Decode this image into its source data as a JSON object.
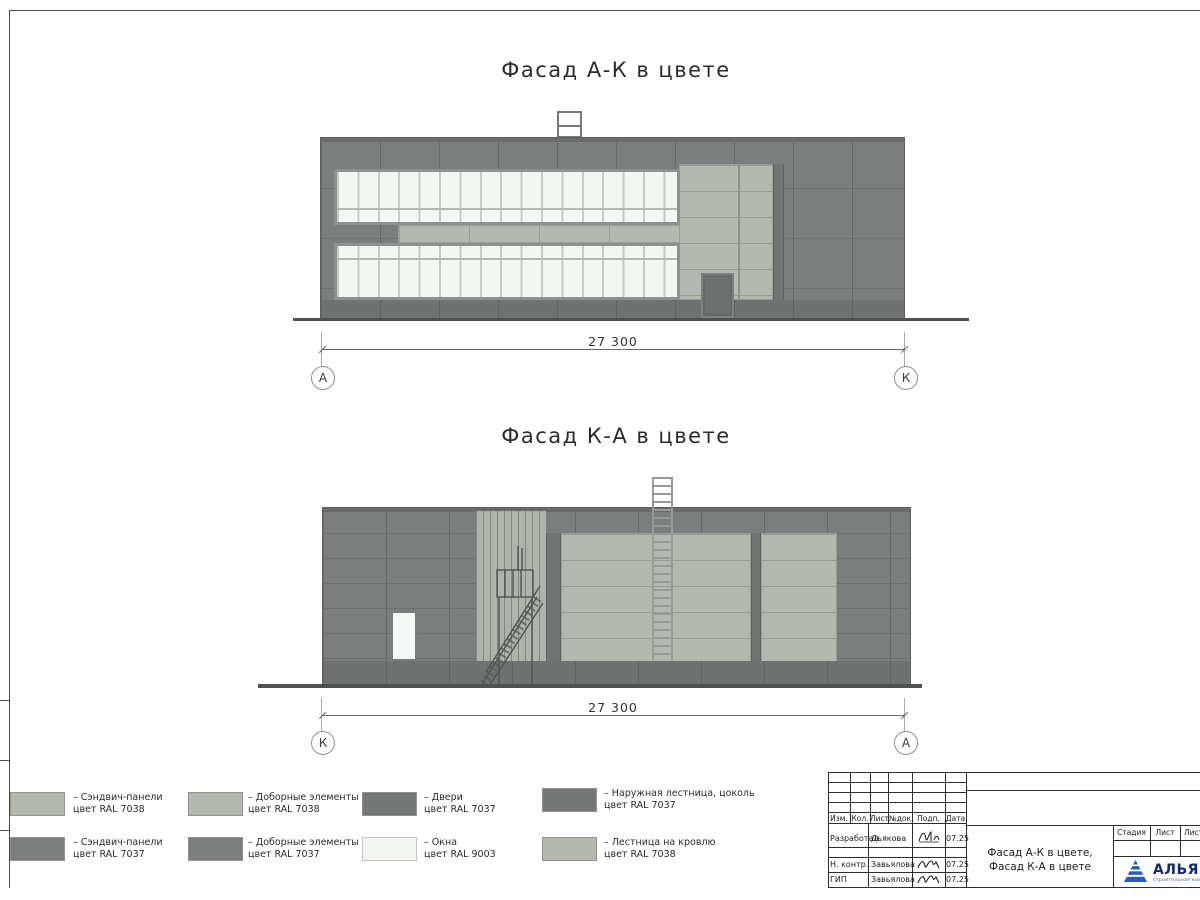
{
  "facade_top": {
    "title": "Фасад А-К в цвете",
    "dimension": "27 300",
    "axis_left": "А",
    "axis_right": "К"
  },
  "facade_bottom": {
    "title": "Фасад К-А в цвете",
    "dimension": "27 300",
    "axis_left": "К",
    "axis_right": "А"
  },
  "legend": [
    {
      "line1": "– Сэндвич-панели",
      "line2": "цвет RAL 7038",
      "color": "#b5b8b1"
    },
    {
      "line1": "– Сэндвич-панели",
      "line2": "цвет RAL 7037",
      "color": "#7b7e7d"
    },
    {
      "line1": "– Доборные элементы",
      "line2": "цвет RAL 7038",
      "color": "#b5b8b1"
    },
    {
      "line1": "– Доборные элементы",
      "line2": "цвет RAL 7037",
      "color": "#7b7e7d"
    },
    {
      "line1": "– Двери",
      "line2": "цвет RAL 7037",
      "color": "#747776"
    },
    {
      "line1": "– Окна",
      "line2": "цвет RAL 9003",
      "color": "#f2f5f0"
    },
    {
      "line1": "– Наружная лестница, цоколь",
      "line2": "цвет RAL 7037",
      "color": "#747776"
    },
    {
      "line1": "– Лестница на кровлю",
      "line2": "цвет RAL 7038",
      "color": "#b5b8b1"
    }
  ],
  "title_block": {
    "col_headers": {
      "izm": "Изм.",
      "kol": "Кол.",
      "list": "Лист",
      "doc": "№док",
      "podp": "Подп.",
      "data": "Дата"
    },
    "rows": [
      {
        "role": "Разработал",
        "name": "Дьякова",
        "date": "07.25"
      },
      {
        "role": "Н. контр.",
        "name": "Завьялова",
        "date": "07.25"
      },
      {
        "role": "ГИП",
        "name": "Завьялова",
        "date": "07.25"
      }
    ],
    "doc_title_1": "Фасад А-К в цвете,",
    "doc_title_2": "Фасад К-А в цвете",
    "stage": "Стадия",
    "sheet": "Лист",
    "sheets": "Листов",
    "logo": {
      "name": "АЛЬЯНС",
      "tagline": "строительная компания"
    }
  }
}
